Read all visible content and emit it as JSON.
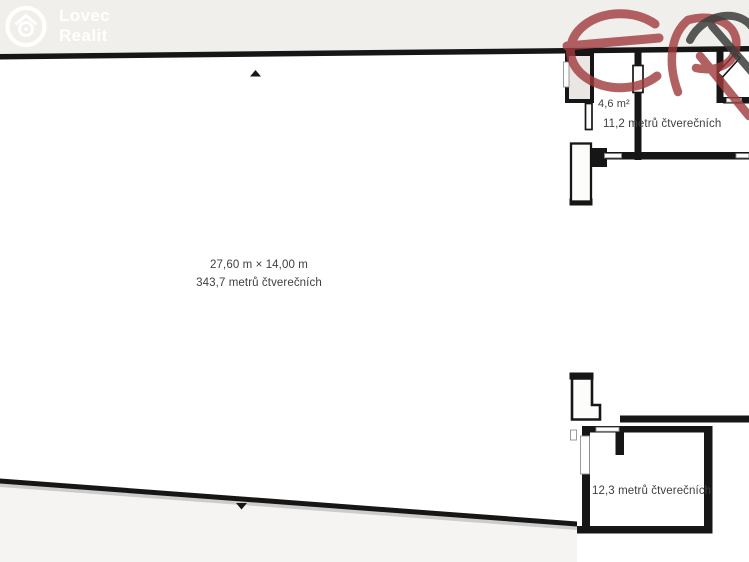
{
  "watermarks": {
    "lovec": {
      "line1": "Lovec",
      "line2": "Realit",
      "icon": "house-camera-circle-icon"
    },
    "er": {
      "letters": "eR",
      "icon": "er-monogram-icon"
    }
  },
  "rooms": {
    "main_hall": {
      "dimensions": "27,60 m × 14,00 m",
      "area": "343,7 metrů čtverečních"
    },
    "small_room": {
      "area": "4,6 m²"
    },
    "top_right_room": {
      "area": "11,2 metrů čtverečních"
    },
    "bottom_right_room": {
      "area": "12,3 metrů čtverečních"
    }
  },
  "markers": {
    "top": "up-triangle",
    "bottom": "down-triangle"
  },
  "colors": {
    "wall": "#161616",
    "page-bg": "#f1efec",
    "interior": "#ffffff",
    "outside-lower": "#f6f4f2",
    "shaft-fill": "#e9e6e3",
    "opening-stroke": "#8f8f8f",
    "label-text": "#3f3f3f",
    "brand-red": "#a03a3c",
    "brand-dark": "#3d3d3d",
    "watermark-white": "#ffffff"
  }
}
